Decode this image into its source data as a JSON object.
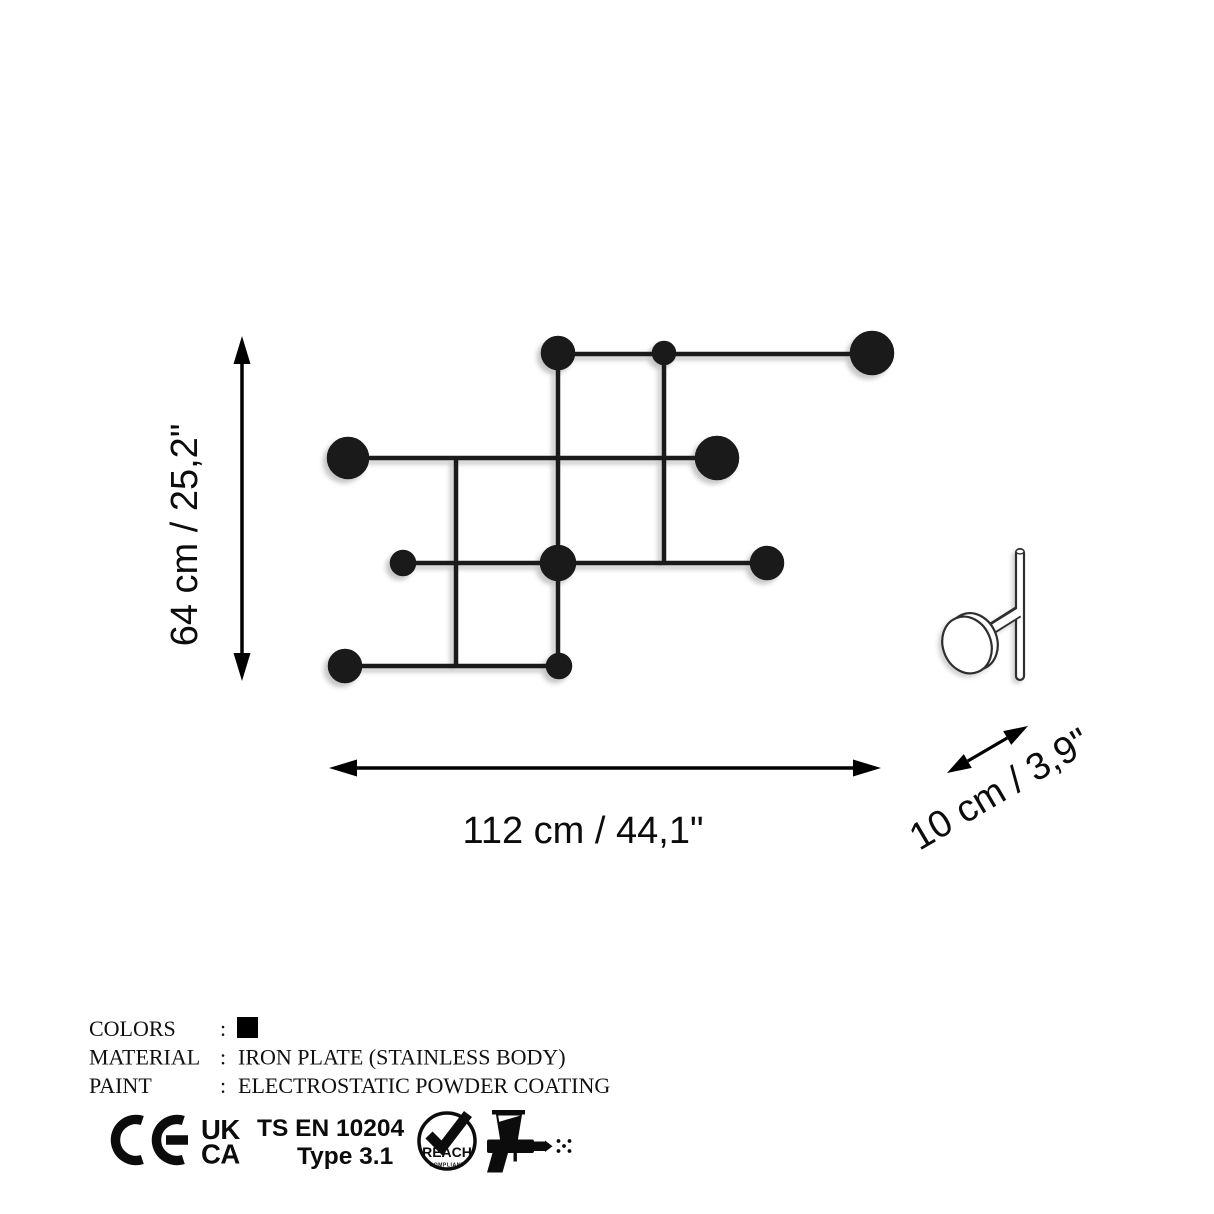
{
  "colors": {
    "ink": "#1a1a1a",
    "arrow": "#000000",
    "outline": "#2e2e2e",
    "background": "#ffffff",
    "swatch": "#000000"
  },
  "dimensions": {
    "height_label": "64 cm / 25,2\"",
    "width_label": "112 cm / 44,1\"",
    "depth_label": "10 cm / 3,9\""
  },
  "specs": {
    "rows": [
      {
        "label": "COLORS",
        "sep": ":",
        "value": ""
      },
      {
        "label": "MATERIAL",
        "sep": ":",
        "value": "IRON PLATE (STAINLESS BODY)"
      },
      {
        "label": "PAINT",
        "sep": ":",
        "value": "ELECTROSTATIC POWDER COATING"
      }
    ]
  },
  "certifications": {
    "ce_icon": "ce-mark-icon",
    "ukca": {
      "line1": "UK",
      "line2": "CA"
    },
    "standard": {
      "line1": "TS EN 10204",
      "line2": "Type 3.1"
    },
    "reach": {
      "label": "REACH",
      "sublabel": "COMPLIANT",
      "icon": "checkmark-icon"
    },
    "paint_icon": "spray-gun-icon"
  }
}
